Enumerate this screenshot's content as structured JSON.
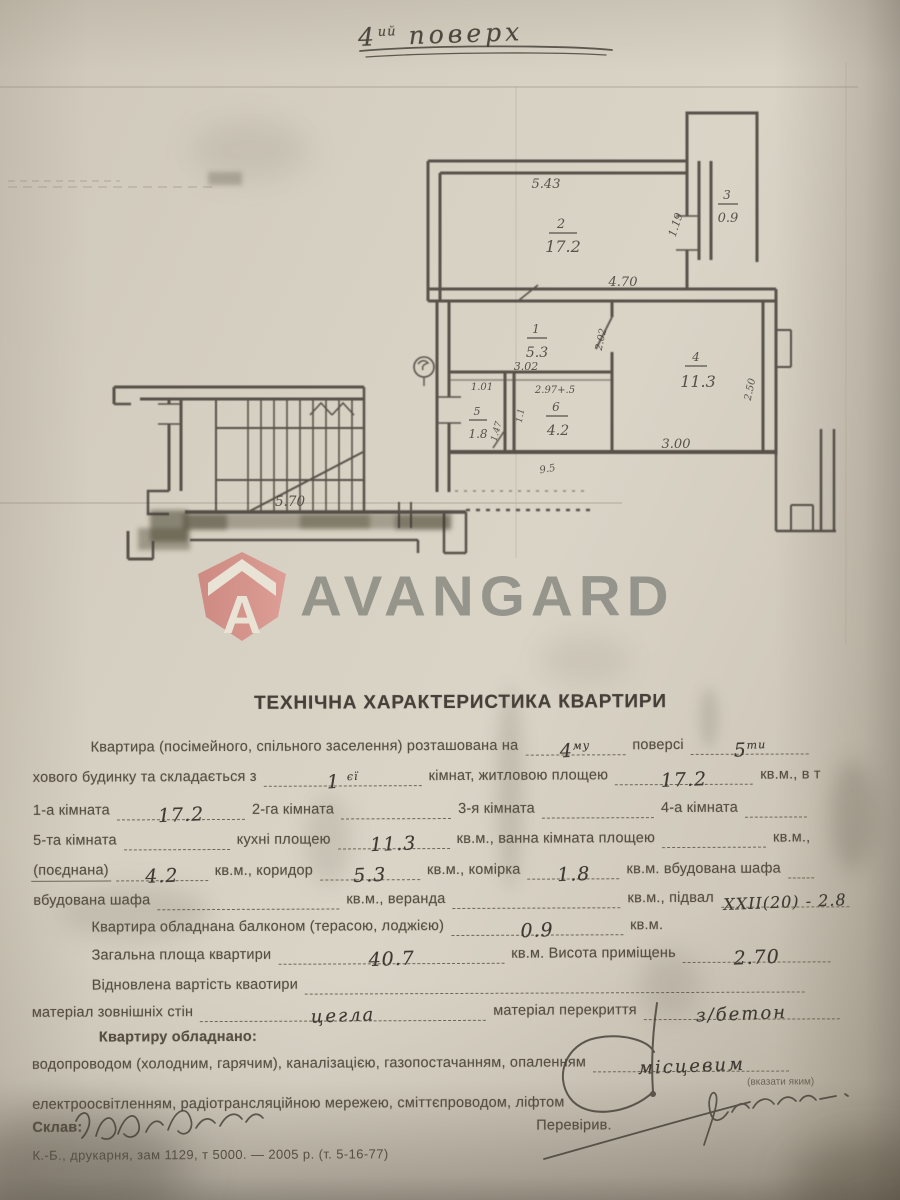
{
  "floor_note": {
    "num": "4",
    "sup": "ий",
    "word": "поверх"
  },
  "logo": {
    "text": "AVANGARD",
    "letter": "A",
    "badge_color": "#d28c85",
    "text_color": "#83847d"
  },
  "plan": {
    "rooms": [
      {
        "num": "2",
        "area": "17.2"
      },
      {
        "num": "3",
        "area": "0.9"
      },
      {
        "num": "1",
        "area": "5.3"
      },
      {
        "num": "5",
        "area": "1.8"
      },
      {
        "num": "6",
        "area": "4.2"
      },
      {
        "num": "4",
        "area": "11.3"
      }
    ],
    "dims": {
      "top": "5.43",
      "room2_bottom": "4.70",
      "balcony_side": "1.19",
      "corridor": "3.02",
      "r5_top": "1.01",
      "r6_top": "2.97+.5",
      "kitchen_bottom": "3.00",
      "kitchen_right": "2.50",
      "stairs": "5.70",
      "bottom_small": "9.5",
      "door_side": "2.02",
      "r5_side": "1.47",
      "r6_side": "1.1"
    }
  },
  "form": {
    "title": "ТЕХНІЧНА ХАРАКТЕРИСТИКА КВАРТИРИ",
    "l1a": "Квартира (посімейного, спільного заселення) розташована на",
    "l1hw1": "4",
    "l1hw1s": "му",
    "l1b": "поверсі",
    "l1hw2": "5",
    "l1hw2s": "ти",
    "l2a": "хового будинку та складається з",
    "l2hw": "1",
    "l2hws": "єї",
    "l2b": "кімнат, житловою площею",
    "l2hw2": "17.2",
    "l2c": "кв.м., в т",
    "l3a": "1-а кімната",
    "l3hw": "17.2",
    "l3b": "2-га кімната",
    "l3c": "3-я кімната",
    "l3d": "4-а кімната",
    "l4a": "5-та кімната",
    "l4b": "кухні площею",
    "l4hw": "11.3",
    "l4c": "кв.м., ванна кімната площею",
    "l4d": "кв.м.,",
    "l5a": "(поєднана)",
    "l5hw1": "4.2",
    "l5b": "кв.м., коридор",
    "l5hw2": "5.3",
    "l5c": "кв.м., комірка",
    "l5hw3": "1.8",
    "l5d": "кв.м. вбудована шафа",
    "l6a": "вбудована шафа",
    "l6b": "кв.м., веранда",
    "l6c": "кв.м., підвал",
    "l6hw": "ХХІІ(20) - 2.8",
    "l7a": "Квартира обладнана балконом (терасою, лоджією)",
    "l7hw": "0.9",
    "l7b": "кв.м.",
    "l8a": "Загальна площа квартири",
    "l8hw": "40.7",
    "l8b": "кв.м. Висота приміщень",
    "l8hw2": "2.70",
    "l9a": "Відновлена вартість кваотири",
    "l10a": "матеріал зовнішніх стін",
    "l10hw": "цегла",
    "l10b": "матеріал перекриття",
    "l10hw2": "з/бетон",
    "l11": "Квартиру обладнано:",
    "l12a": "водопроводом (холодним, гарячим), каналізацією, газопостачанням, опаленням",
    "l12hw": "місцевим",
    "l12note": "(вказати яким)",
    "l13": "електроосвітленням, радіотрансляційною мережею, сміттєпроводом, ліфтом",
    "l14a": "Склав:",
    "l14b": "Перевірив.",
    "l15": "К.-Б., друкарня, зам 1129, т 5000. — 2005 р. (т. 5-16-77)"
  }
}
